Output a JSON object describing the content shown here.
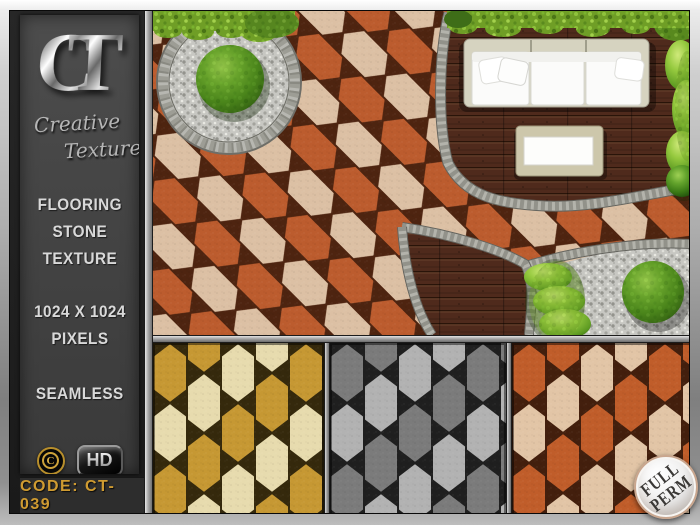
{
  "sidebar": {
    "logo_c": "C",
    "logo_t": "T",
    "brand_line1": "Creative",
    "brand_line2": "Textures",
    "heading_lines": [
      "FLOORING",
      "STONE",
      "TEXTURE"
    ],
    "size_line1": "1024 X 1024",
    "size_line2": "PIXELS",
    "seamless_label": "SEAMLESS",
    "copyright_letter": "C",
    "hd_label": "HD",
    "permissions_label": "COPY ✦ MODY ✦ TRANS",
    "code_label": "CODE: CT-039"
  },
  "badge": {
    "line1": "FULL",
    "line2": "PERM"
  },
  "colors": {
    "accent_green": "#3aa318",
    "accent_gold": "#cf9b31",
    "badge_rim": "#c9a68e",
    "paver_a": "#bc5c2e",
    "paver_b": "#dcc0a4",
    "paver_grout": "#4e2410",
    "gold_a": "#c69833",
    "gold_b": "#e7dbae",
    "gold_grout": "#35290c",
    "gray_a": "#7b7b7b",
    "gray_b": "#b2b2b2",
    "gray_grout": "#1f1f1f",
    "orange_a": "#c05d2a",
    "orange_b": "#e2c5a6",
    "orange_grout": "#431f0d",
    "deck": "#4f2a1c",
    "gravel": "#c7c7c2",
    "hedge": "#6f9e26"
  }
}
